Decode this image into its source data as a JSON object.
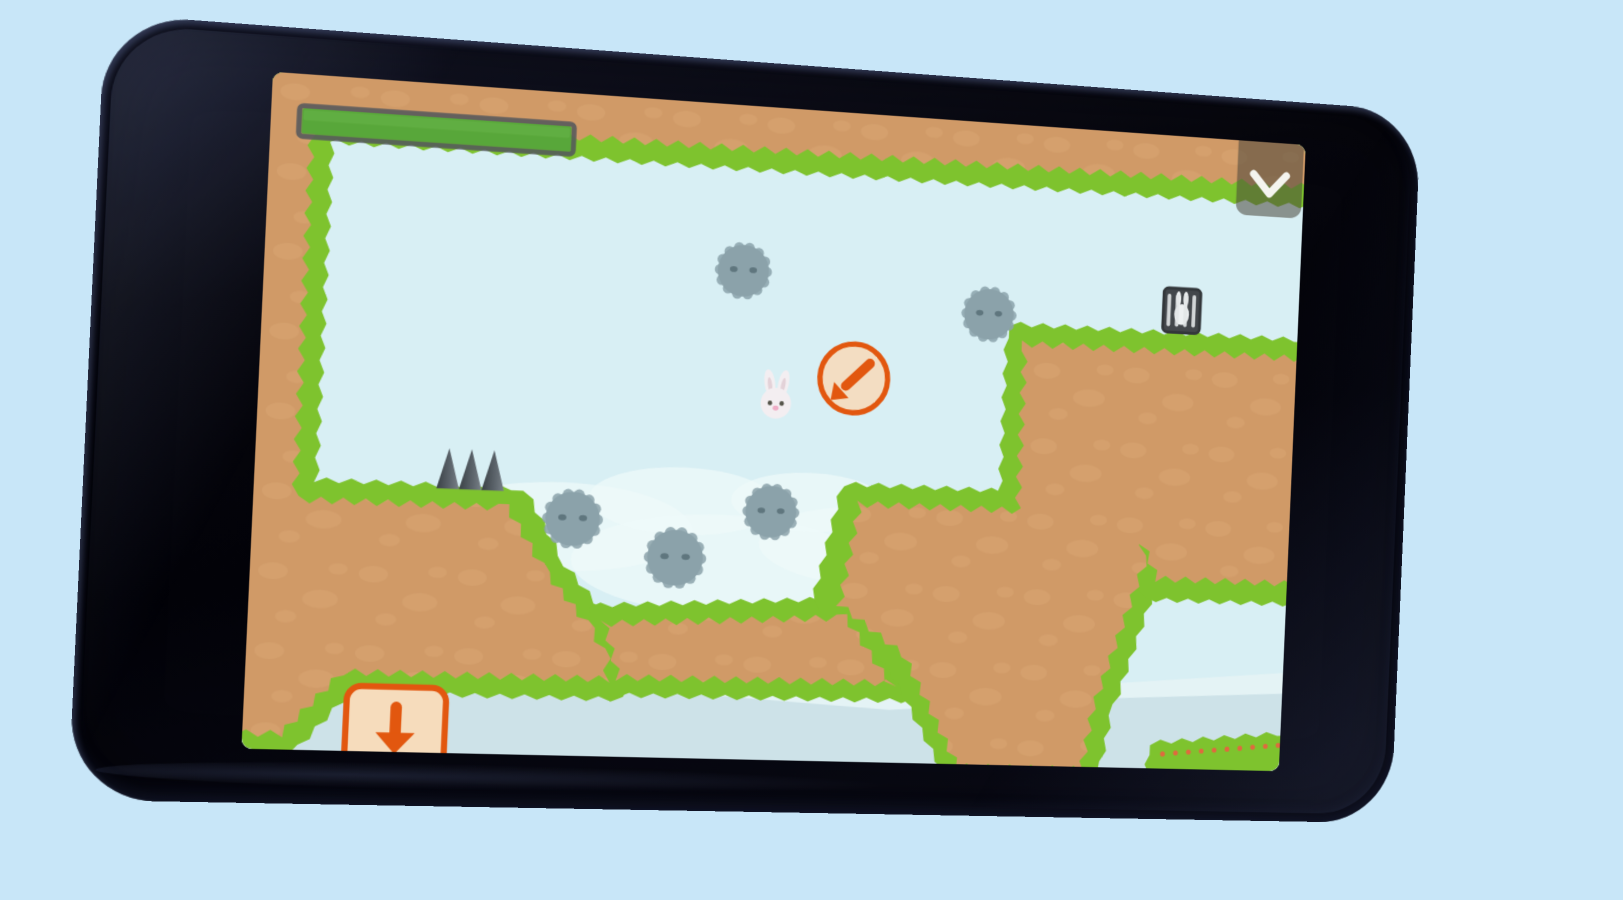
{
  "page": {
    "background": "#c8e6f8"
  },
  "phone": {
    "body_color": "#07070e",
    "sheen_color": "#2a3354"
  },
  "game": {
    "colors": {
      "sky": "#d8eff4",
      "cloud": "#eff9fa",
      "cloud_band_light": "#e4f3f5",
      "cloud_band": "#cde2e8",
      "grass": "#7ec32e",
      "dirt": "#d09a67",
      "dirt_blob": "#d9a673",
      "spike_dark": "#3a4146",
      "spike_mid": "#5d656c",
      "spike_light": "#788087",
      "enemy_body": "#8ba2aa",
      "enemy_eye": "#5f767e",
      "bunny_white": "#f3eef1",
      "bunny_ear_inner": "#e3d2d8",
      "bunny_eye": "#55544a",
      "bunny_nose": "#efadc6",
      "accent_orange": "#e2570f",
      "ring_fill": "#f3ddc2",
      "button_fill": "#f6dcbc",
      "hud_bar_fill": "#58a73a",
      "hud_bar_highlight": "#68b54a",
      "hud_bar_border": "#54585c",
      "hud_panel": "rgba(72,70,58,0.55)",
      "hud_icon": "#f4f4ef",
      "cage_frame": "#43474b",
      "cage_bar": "#e2e6e7",
      "cage_bunny": "#edf0f1",
      "flower_dot": "#df6a3e"
    },
    "hud": {
      "progress_bar": {
        "x": 27,
        "y": 31,
        "width": 267,
        "height": 30,
        "fill_ratio": 1
      },
      "collapse_button": {
        "x": 986,
        "y": -10,
        "width": 72,
        "height": 88,
        "icon": "chevron-down"
      }
    },
    "level": {
      "terrain": [
        {
          "name": "top-bar",
          "green": [
            [
              -8,
              -8
            ],
            [
              1068,
              -8
            ],
            [
              1068,
              62
            ],
            [
              -8,
              62
            ]
          ],
          "dirt": [
            [
              -8,
              -8
            ],
            [
              1068,
              -8
            ],
            [
              1068,
              47
            ],
            [
              -8,
              47
            ]
          ]
        },
        {
          "name": "left-structure",
          "green": [
            [
              -8,
              -8
            ],
            [
              57,
              -8
            ],
            [
              57,
              398
            ],
            [
              260,
              398
            ],
            [
              303,
              472
            ],
            [
              350,
              525
            ],
            [
              368,
              558
            ],
            [
              368,
              600
            ],
            [
              100,
              600
            ],
            [
              45,
              664
            ],
            [
              -8,
              664
            ]
          ],
          "dirt": [
            [
              -8,
              -8
            ],
            [
              43,
              -8
            ],
            [
              43,
              412
            ],
            [
              247,
              412
            ],
            [
              290,
              478
            ],
            [
              337,
              532
            ],
            [
              354,
              562
            ],
            [
              354,
              586
            ],
            [
              94,
              586
            ],
            [
              38,
              648
            ],
            [
              -8,
              648
            ]
          ]
        },
        {
          "name": "pit-floor",
          "green": [
            [
              330,
              512
            ],
            [
              600,
              496
            ],
            [
              664,
              594
            ],
            [
              350,
              596
            ]
          ],
          "dirt": [
            [
              342,
              524
            ],
            [
              592,
              510
            ],
            [
              646,
              582
            ],
            [
              360,
              584
            ]
          ]
        },
        {
          "name": "mid-platform",
          "green": [
            [
              583,
              380
            ],
            [
              914,
              380
            ],
            [
              920,
              452
            ],
            [
              872,
              606
            ],
            [
              862,
              666
            ],
            [
              700,
              666
            ],
            [
              638,
              560
            ],
            [
              558,
              498
            ]
          ],
          "dirt": [
            [
              597,
              394
            ],
            [
              900,
              394
            ],
            [
              906,
              450
            ],
            [
              858,
              600
            ],
            [
              848,
              666
            ],
            [
              712,
              666
            ],
            [
              650,
              552
            ],
            [
              580,
              502
            ]
          ]
        },
        {
          "name": "right-platform",
          "green": [
            [
              748,
              208
            ],
            [
              1068,
              208
            ],
            [
              1068,
              482
            ],
            [
              906,
              482
            ],
            [
              879,
              420
            ],
            [
              879,
              392
            ],
            [
              748,
              392
            ]
          ],
          "dirt": [
            [
              762,
              222
            ],
            [
              1068,
              222
            ],
            [
              1068,
              466
            ],
            [
              916,
              466
            ],
            [
              893,
              418
            ],
            [
              893,
              406
            ],
            [
              762,
              406
            ]
          ]
        },
        {
          "name": "lower-right-ledge",
          "green": [
            [
              918,
              636
            ],
            [
              1068,
              622
            ],
            [
              1068,
              666
            ],
            [
              918,
              666
            ]
          ],
          "dirt": [],
          "flower_dots": {
            "x_start": 932,
            "x_end": 1062,
            "step": 14,
            "offset_below_top": 10
          }
        }
      ],
      "spikes": {
        "base_y": 399,
        "half_width": 11,
        "height": 40,
        "centers_x": [
          186,
          208,
          230
        ]
      },
      "enemies": [
        {
          "x": 470,
          "y": 167,
          "r": 26
        },
        {
          "x": 726,
          "y": 197,
          "r": 26
        },
        {
          "x": 310,
          "y": 424,
          "r": 27
        },
        {
          "x": 414,
          "y": 459,
          "r": 28
        },
        {
          "x": 509,
          "y": 409,
          "r": 26
        }
      ],
      "bunny": {
        "x": 509,
        "y": 299
      },
      "hint_ring": {
        "x": 588,
        "y": 270,
        "r": 35,
        "arrow": "down-left"
      },
      "cage": {
        "x": 932,
        "y": 182,
        "width": 40,
        "height": 46
      },
      "down_button": {
        "x": 98,
        "y": 596,
        "width": 96,
        "height": 92,
        "icon": "arrow-down"
      },
      "clouds": [
        [
          300,
          432,
          130,
          44
        ],
        [
          460,
          464,
          150,
          50
        ],
        [
          610,
          440,
          112,
          40
        ],
        [
          420,
          402,
          95,
          34
        ],
        [
          548,
          398,
          80,
          30
        ]
      ],
      "bands": {
        "light": [
          [
            -8,
            572
          ],
          [
            200,
            552
          ],
          [
            430,
            572
          ],
          [
            640,
            586
          ],
          [
            860,
            574
          ],
          [
            1068,
            556
          ]
        ],
        "dark": [
          [
            -8,
            596
          ],
          [
            180,
            576
          ],
          [
            420,
            594
          ],
          [
            640,
            606
          ],
          [
            880,
            588
          ],
          [
            1068,
            578
          ]
        ]
      }
    }
  }
}
